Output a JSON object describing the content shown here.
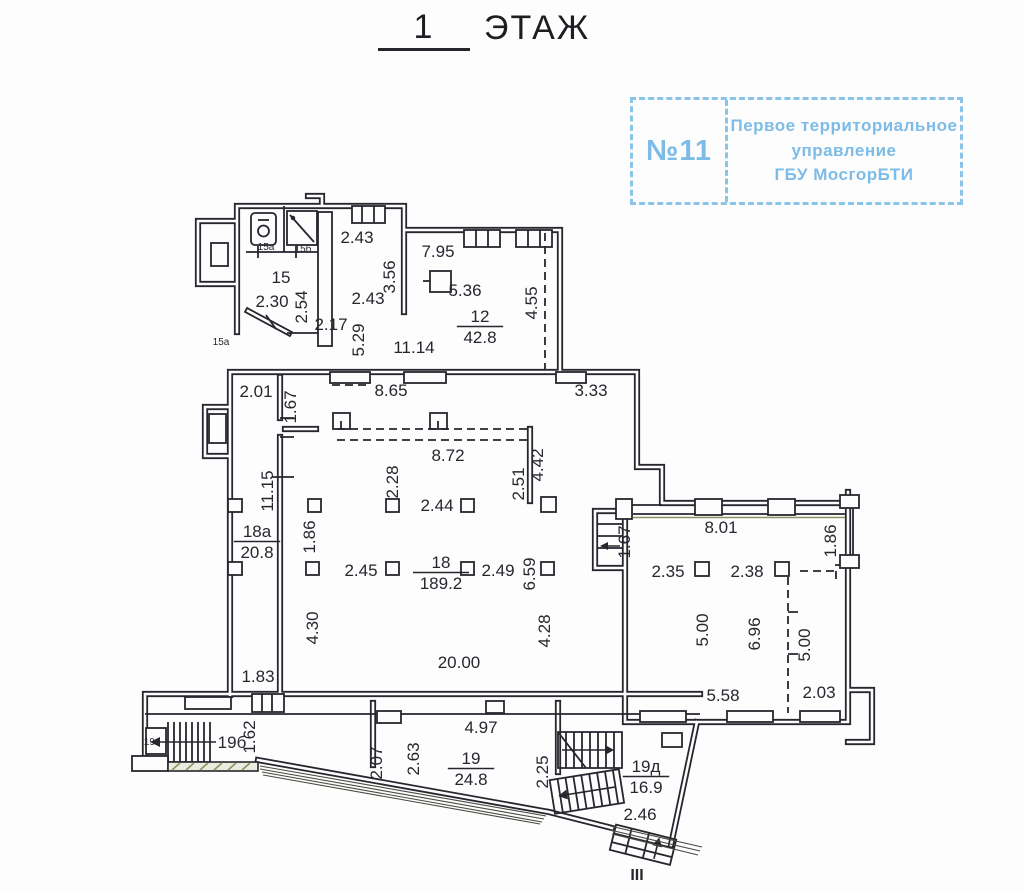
{
  "title": {
    "number": "1",
    "word": "ЭТАЖ"
  },
  "stamp": {
    "number": "№11",
    "lines": [
      "Первое территориальное",
      "управление",
      "ГБУ МосгорБТИ"
    ]
  },
  "colors": {
    "ink": "#26262e",
    "stamp_blue": "#7dbce6",
    "accent_olive": "#8f9160",
    "marker_red": "#c2453f"
  },
  "plan": {
    "dimensions": [
      {
        "t": "2.43",
        "x": 357,
        "y": 243
      },
      {
        "t": "7.95",
        "x": 438,
        "y": 257
      },
      {
        "t": "5.36",
        "x": 465,
        "y": 296
      },
      {
        "t": "2.43",
        "x": 368,
        "y": 304
      },
      {
        "t": "2.30",
        "x": 272,
        "y": 307
      },
      {
        "t": "2.17",
        "x": 331,
        "y": 330
      },
      {
        "t": "11.14",
        "x": 414,
        "y": 353
      },
      {
        "t": "3.56",
        "x": 395,
        "y": 277,
        "v": 1
      },
      {
        "t": "2.54",
        "x": 307,
        "y": 307,
        "v": 1
      },
      {
        "t": "5.29",
        "x": 364,
        "y": 340,
        "v": 1
      },
      {
        "t": "4.55",
        "x": 537,
        "y": 303,
        "v": 1
      },
      {
        "t": "2.01",
        "x": 256,
        "y": 397
      },
      {
        "t": "8.65",
        "x": 391,
        "y": 396
      },
      {
        "t": "3.33",
        "x": 591,
        "y": 396
      },
      {
        "t": "1.67",
        "x": 296,
        "y": 407,
        "v": 1
      },
      {
        "t": "8.72",
        "x": 448,
        "y": 461
      },
      {
        "t": "2.28",
        "x": 398,
        "y": 482,
        "v": 1
      },
      {
        "t": "2.51",
        "x": 524,
        "y": 484,
        "v": 1
      },
      {
        "t": "4.42",
        "x": 543,
        "y": 465,
        "v": 1
      },
      {
        "t": "11.15",
        "x": 273,
        "y": 491,
        "v": 1
      },
      {
        "t": "2.44",
        "x": 437,
        "y": 511
      },
      {
        "t": "1.86",
        "x": 315,
        "y": 537,
        "v": 1
      },
      {
        "t": "2.45",
        "x": 361,
        "y": 576
      },
      {
        "t": "2.49",
        "x": 498,
        "y": 576
      },
      {
        "t": "6.59",
        "x": 535,
        "y": 574,
        "v": 1
      },
      {
        "t": "4.30",
        "x": 318,
        "y": 628,
        "v": 1
      },
      {
        "t": "4.28",
        "x": 550,
        "y": 631,
        "v": 1
      },
      {
        "t": "20.00",
        "x": 459,
        "y": 668
      },
      {
        "t": "1.83",
        "x": 258,
        "y": 682
      },
      {
        "t": "1.67",
        "x": 630,
        "y": 542,
        "v": 1
      },
      {
        "t": "8.01",
        "x": 721,
        "y": 533
      },
      {
        "t": "1.86",
        "x": 836,
        "y": 541,
        "v": 1
      },
      {
        "t": "2.35",
        "x": 668,
        "y": 577
      },
      {
        "t": "2.38",
        "x": 747,
        "y": 577
      },
      {
        "t": "5.00",
        "x": 708,
        "y": 630,
        "v": 1
      },
      {
        "t": "6.96",
        "x": 760,
        "y": 634,
        "v": 1
      },
      {
        "t": "5.00",
        "x": 810,
        "y": 645,
        "v": 1
      },
      {
        "t": "5.58",
        "x": 723,
        "y": 701
      },
      {
        "t": "2.03",
        "x": 819,
        "y": 698
      },
      {
        "t": "1.62",
        "x": 255,
        "y": 737,
        "v": 1
      },
      {
        "t": "2.07",
        "x": 382,
        "y": 763,
        "v": 1
      },
      {
        "t": "2.63",
        "x": 419,
        "y": 759,
        "v": 1
      },
      {
        "t": "4.97",
        "x": 481,
        "y": 733
      },
      {
        "t": "2.25",
        "x": 548,
        "y": 772,
        "v": 1
      },
      {
        "t": "2.46",
        "x": 640,
        "y": 820
      }
    ],
    "room_tags": [
      {
        "num": "12",
        "area": "42.8",
        "x": 480,
        "y": 322
      },
      {
        "num": "18а",
        "area": "20.8",
        "x": 257,
        "y": 537
      },
      {
        "num": "18",
        "area": "189.2",
        "x": 441,
        "y": 568
      },
      {
        "num": "19",
        "area": "24.8",
        "x": 471,
        "y": 764
      },
      {
        "num": "19д",
        "area": "16.9",
        "x": 646,
        "y": 772
      }
    ],
    "plain_rooms": [
      {
        "t": "15",
        "x": 281,
        "y": 283
      },
      {
        "t": "19б",
        "x": 232,
        "y": 748
      }
    ],
    "small_labels": [
      {
        "t": "15а",
        "x": 266,
        "y": 250
      },
      {
        "t": "15б",
        "x": 303,
        "y": 252
      },
      {
        "t": "15а",
        "x": 221,
        "y": 345
      },
      {
        "t": "19в",
        "x": 152,
        "y": 745
      }
    ],
    "entrance_marker": {
      "t": "III",
      "x": 637,
      "y": 880,
      "color": "#c2453f",
      "fs": 16,
      "b": 1
    }
  }
}
